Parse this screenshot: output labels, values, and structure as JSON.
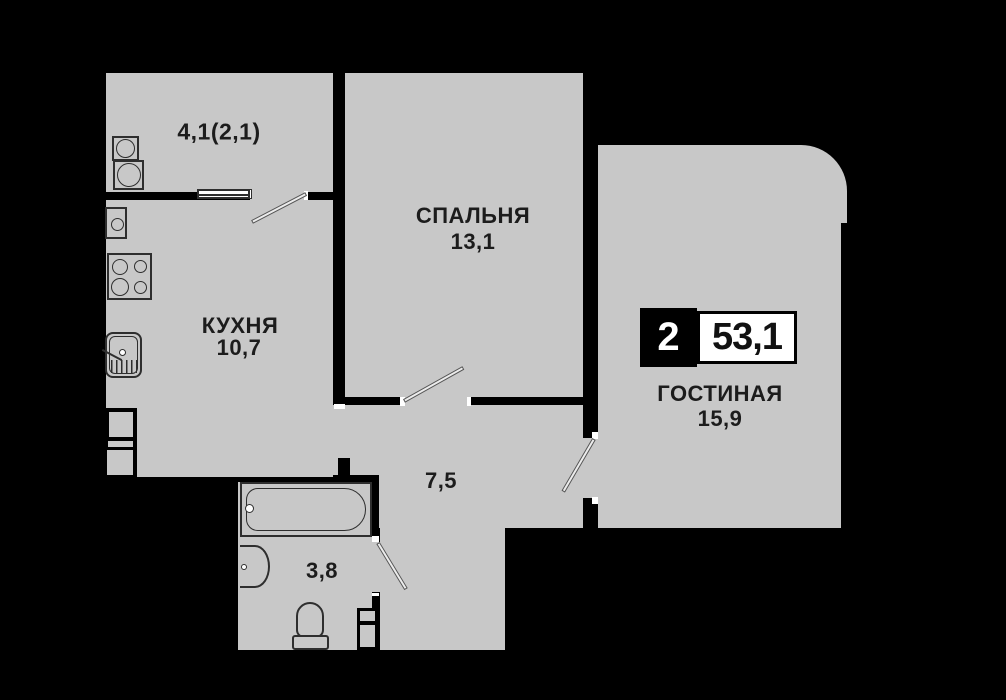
{
  "plan_type": "apartment-floor-plan",
  "badge": {
    "rooms_count": "2",
    "total_area": "53,1"
  },
  "rooms": {
    "balcony": {
      "label": "4,1(2,1)"
    },
    "bedroom": {
      "name": "СПАЛЬНЯ",
      "area": "13,1"
    },
    "kitchen": {
      "name": "КУХНЯ",
      "area": "10,7"
    },
    "living": {
      "name": "ГОСТИНАЯ",
      "area": "15,9"
    },
    "hallway": {
      "area": "7,5"
    },
    "bathroom": {
      "area": "3,8"
    }
  },
  "colors": {
    "floor": "#c8c8c8",
    "walls_background": "#000000",
    "text": "#1c1c1c",
    "badge_rooms_bg": "#000000",
    "badge_area_bg": "#ffffff"
  },
  "fixtures": {
    "balcony": [
      "stacked-washer-icon",
      "stacked-dryer-icon"
    ],
    "kitchen": [
      "water-heater-icon",
      "stove-icon",
      "kitchen-sink-icon",
      "ventilation-shaft-icon"
    ],
    "bathroom": [
      "bathtub-icon",
      "washbasin-icon",
      "toilet-icon",
      "ventilation-shaft-icon"
    ],
    "openings": [
      "balcony-window",
      "balcony-door",
      "bedroom-door",
      "living-room-door",
      "bathroom-door"
    ]
  }
}
